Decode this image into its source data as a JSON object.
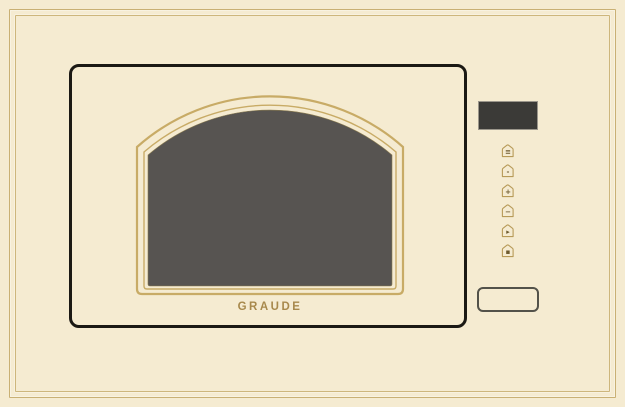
{
  "brand": {
    "logo": "GRAUDE"
  },
  "colors": {
    "background": "#f5ebd1",
    "frame_gold": "#c9b074",
    "door_outline": "#1b1914",
    "window_molding_gold": "#c8ab66",
    "window_glass_dark": "#575451",
    "display_dark": "#3b3a37",
    "logo_gold": "#a8894c",
    "button_gold": "#b79a58",
    "open_button_outline": "#53524a"
  },
  "control_panel": {
    "display_value": "",
    "buttons": [
      {
        "id": "timer",
        "glyph": "≡"
      },
      {
        "id": "weight",
        "glyph": "-"
      },
      {
        "id": "plus",
        "glyph": "+"
      },
      {
        "id": "minus",
        "glyph": "−"
      },
      {
        "id": "start",
        "glyph": "▸"
      },
      {
        "id": "stop",
        "glyph": "▪"
      }
    ],
    "open_button_label": ""
  }
}
